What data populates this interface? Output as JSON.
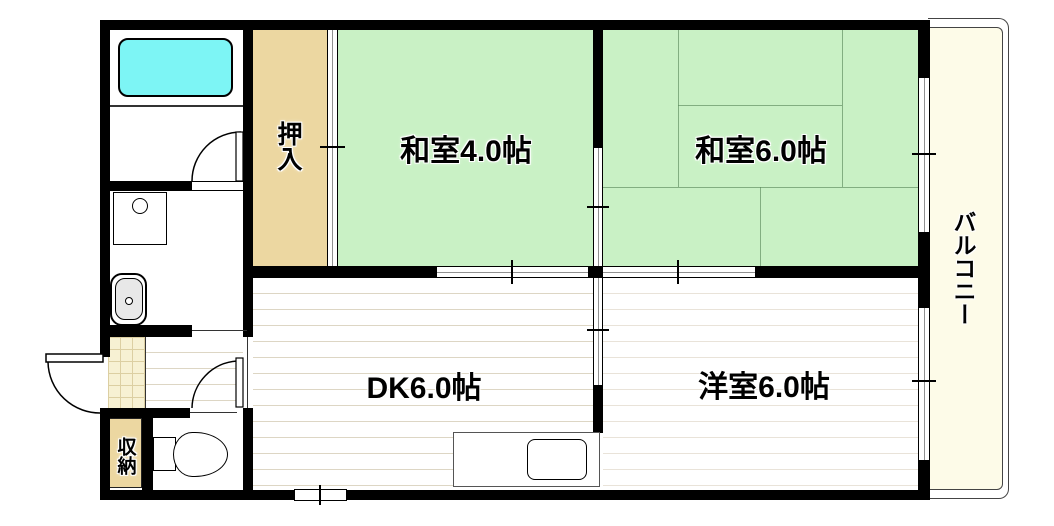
{
  "rooms": {
    "washitsu4": {
      "label": "和室4.0帖",
      "type": "japanese-tatami-room",
      "size_jo": 4.0
    },
    "washitsu6": {
      "label": "和室6.0帖",
      "type": "japanese-tatami-room",
      "size_jo": 6.0
    },
    "dk": {
      "label": "DK6.0帖",
      "type": "dining-kitchen",
      "size_jo": 6.0
    },
    "yoshitsu": {
      "label": "洋室6.0帖",
      "type": "western-room",
      "size_jo": 6.0
    },
    "oshiire": {
      "label": "押入",
      "type": "closet"
    },
    "shuno": {
      "label": "収納",
      "type": "storage"
    },
    "balcony": {
      "label": "バルコニー",
      "type": "balcony"
    }
  },
  "fixtures": [
    "bathtub",
    "washing-machine-pan",
    "washbasin",
    "toilet",
    "kitchen-counter",
    "kitchen-sink",
    "entrance-door",
    "bathroom-door",
    "toilet-door",
    "sliding-doors",
    "windows",
    "balcony-rail"
  ],
  "colors": {
    "wall-black": "#000000",
    "tatami-green": "#c9f1c5",
    "tatami-line": "#5c8a5c",
    "closet-tan": "#ecd7a1",
    "genkan-tile": "#f7f1d3",
    "balcony-cream": "#fdfbe8",
    "bathtub-cyan": "#7df5f5",
    "fixture-gray": "#e8e8e8",
    "floor-line": "#ddd6c4",
    "floor-line-light": "#e9e3d9"
  }
}
